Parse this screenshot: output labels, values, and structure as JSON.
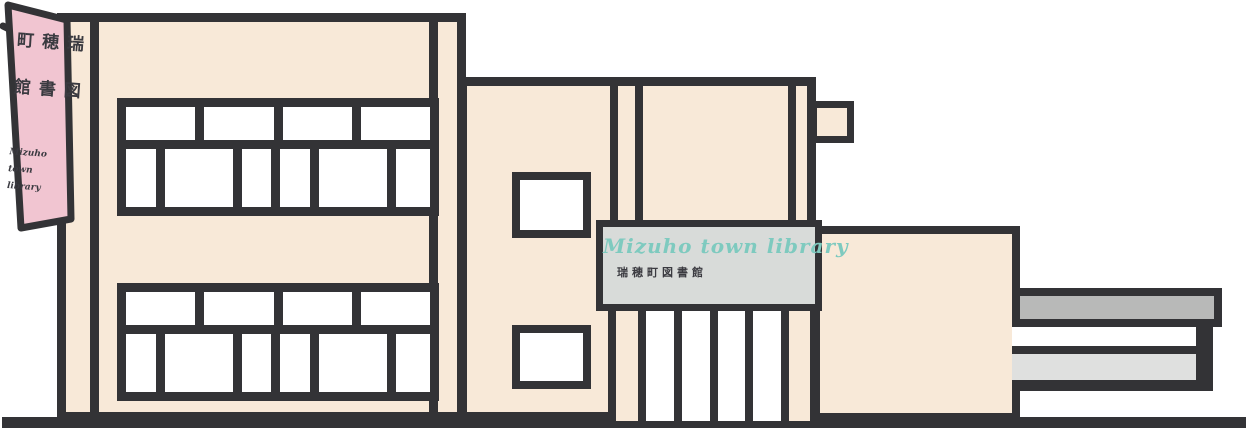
{
  "banner": {
    "vertical_text_right": "瑞穂町",
    "vertical_text_left": "図書館",
    "script_lines": [
      "Mizuho",
      "town",
      "library"
    ]
  },
  "sign": {
    "script_text": "Mizuho town library",
    "japanese_text": "瑞穂町図書館"
  },
  "colors": {
    "dark": "#333336",
    "cream": "#f8e9d8",
    "pink": "#f1c5d1",
    "sign": "#d8dbd9",
    "teal": "#7ecabf",
    "gray1": "#b8b9b8",
    "gray2": "#dfe0df",
    "ink": "#3a3a40"
  }
}
